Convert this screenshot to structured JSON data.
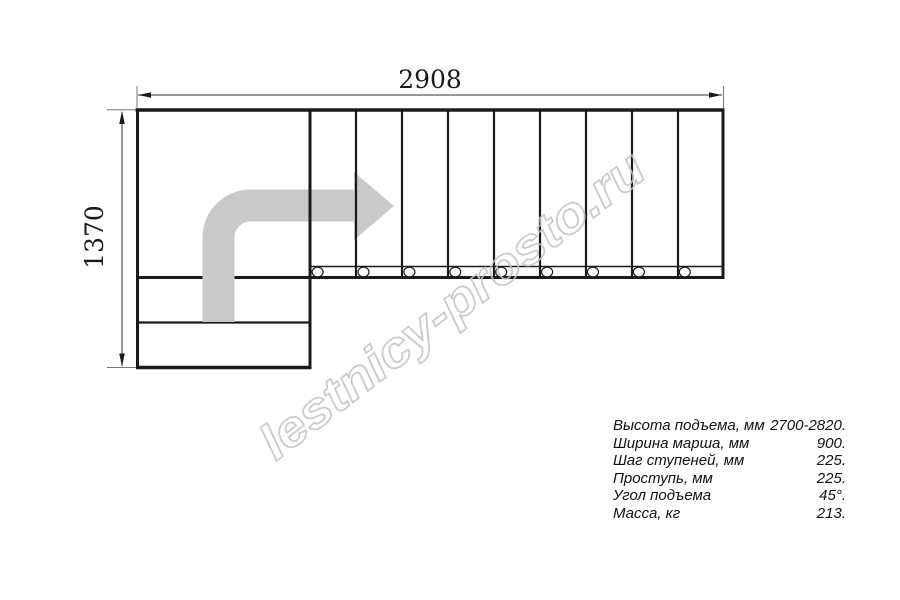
{
  "drawing": {
    "title": "L-shaped staircase top view plan",
    "dim_width_label": "2908",
    "dim_height_label": "1370"
  },
  "watermark": {
    "text": "lestnicy-prosto.ru"
  },
  "specs": {
    "rows": [
      {
        "label": "Высота подъема, мм",
        "value": "2700-2820."
      },
      {
        "label": "Ширина марша, мм",
        "value": "900."
      },
      {
        "label": "Шаг ступеней, мм",
        "value": "225."
      },
      {
        "label": "Проступь, мм",
        "value": "225."
      },
      {
        "label": "Угол подъема",
        "value": "45°."
      },
      {
        "label": "Масса, кг",
        "value": "213."
      }
    ]
  },
  "colors": {
    "line": "#1a1a1a",
    "arrow": "#c9c9c9",
    "watermark": "#c3c3c3"
  }
}
